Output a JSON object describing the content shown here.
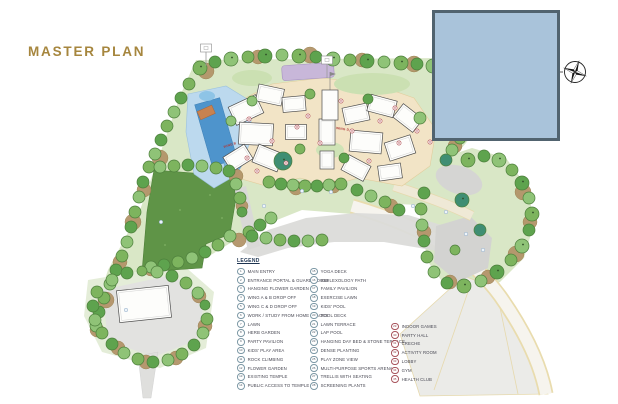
{
  "page": {
    "title": "MASTER PLAN"
  },
  "colors": {
    "title_gold": "#a6863e",
    "cover_fill": "#a9c3da",
    "cover_border": "#51636f",
    "site_green": "#d9e7c6",
    "lawn_green": "#5f9447",
    "pool_blue": "#4e94cc",
    "legend_circle": "#7d99a6",
    "legend_circle_accent": "#a8545c"
  },
  "plan": {
    "wing_labels": [
      {
        "text": "WING B"
      },
      {
        "text": "WING D"
      }
    ]
  },
  "legend": {
    "heading": "LEGEND",
    "columns": [
      {
        "items": [
          {
            "num": "1",
            "label": "MAIN ENTRY"
          },
          {
            "num": "2",
            "label": "ENTRANCE PORTAL & GUARD HOUSE"
          },
          {
            "num": "3",
            "label": "HANGING FLOWER GARDEN"
          },
          {
            "num": "4",
            "label": "WING A & B DROP OFF"
          },
          {
            "num": "5",
            "label": "WING C & D DROP OFF"
          },
          {
            "num": "6",
            "label": "WORK / STUDY FROM HOME SPACES"
          },
          {
            "num": "7",
            "label": "LAWN"
          },
          {
            "num": "8",
            "label": "HERB GARDEN"
          },
          {
            "num": "9",
            "label": "PARTY PAVILION"
          },
          {
            "num": "10",
            "label": "KIDS' PLAY AREA"
          },
          {
            "num": "11",
            "label": "ROCK CLIMBING"
          },
          {
            "num": "12",
            "label": "FLOWER GARDEN"
          },
          {
            "num": "13",
            "label": "EXISTING TEMPLE"
          },
          {
            "num": "14",
            "label": "PUBLIC ACCESS TO TEMPLE"
          }
        ]
      },
      {
        "items": [
          {
            "num": "15",
            "label": "YOGA DECK"
          },
          {
            "num": "16",
            "label": "REFLEXOLOGY PATH"
          },
          {
            "num": "17",
            "label": "FAMILY PAVILION"
          },
          {
            "num": "18",
            "label": "EXERCISE LAWN"
          },
          {
            "num": "19",
            "label": "KIDS' POOL"
          },
          {
            "num": "20",
            "label": "POOL DECK"
          },
          {
            "num": "21",
            "label": "LAWN TERRACE"
          },
          {
            "num": "22",
            "label": "LAP POOL"
          },
          {
            "num": "23",
            "label": "HANGING DAY BED & STONE TERRACE"
          },
          {
            "num": "24",
            "label": "DENSE PLANTING"
          },
          {
            "num": "25",
            "label": "PLAY ZONE VIEW"
          },
          {
            "num": "26",
            "label": "MULTI-PURPOSE SPORTS ARENA"
          },
          {
            "num": "27",
            "label": "TRELLIS WITH SEATING"
          },
          {
            "num": "28",
            "label": "SCREENING PLANTS"
          }
        ]
      },
      {
        "items": [
          {
            "num": "29",
            "label": "INDOOR GAMES"
          },
          {
            "num": "30",
            "label": "PARTY HALL"
          },
          {
            "num": "31",
            "label": "CRECHE"
          },
          {
            "num": "32",
            "label": "ACTIVITY ROOM"
          },
          {
            "num": "33",
            "label": "LOBBY"
          },
          {
            "num": "34",
            "label": "GYM"
          },
          {
            "num": "35",
            "label": "HEALTH CLUB"
          }
        ]
      }
    ]
  }
}
